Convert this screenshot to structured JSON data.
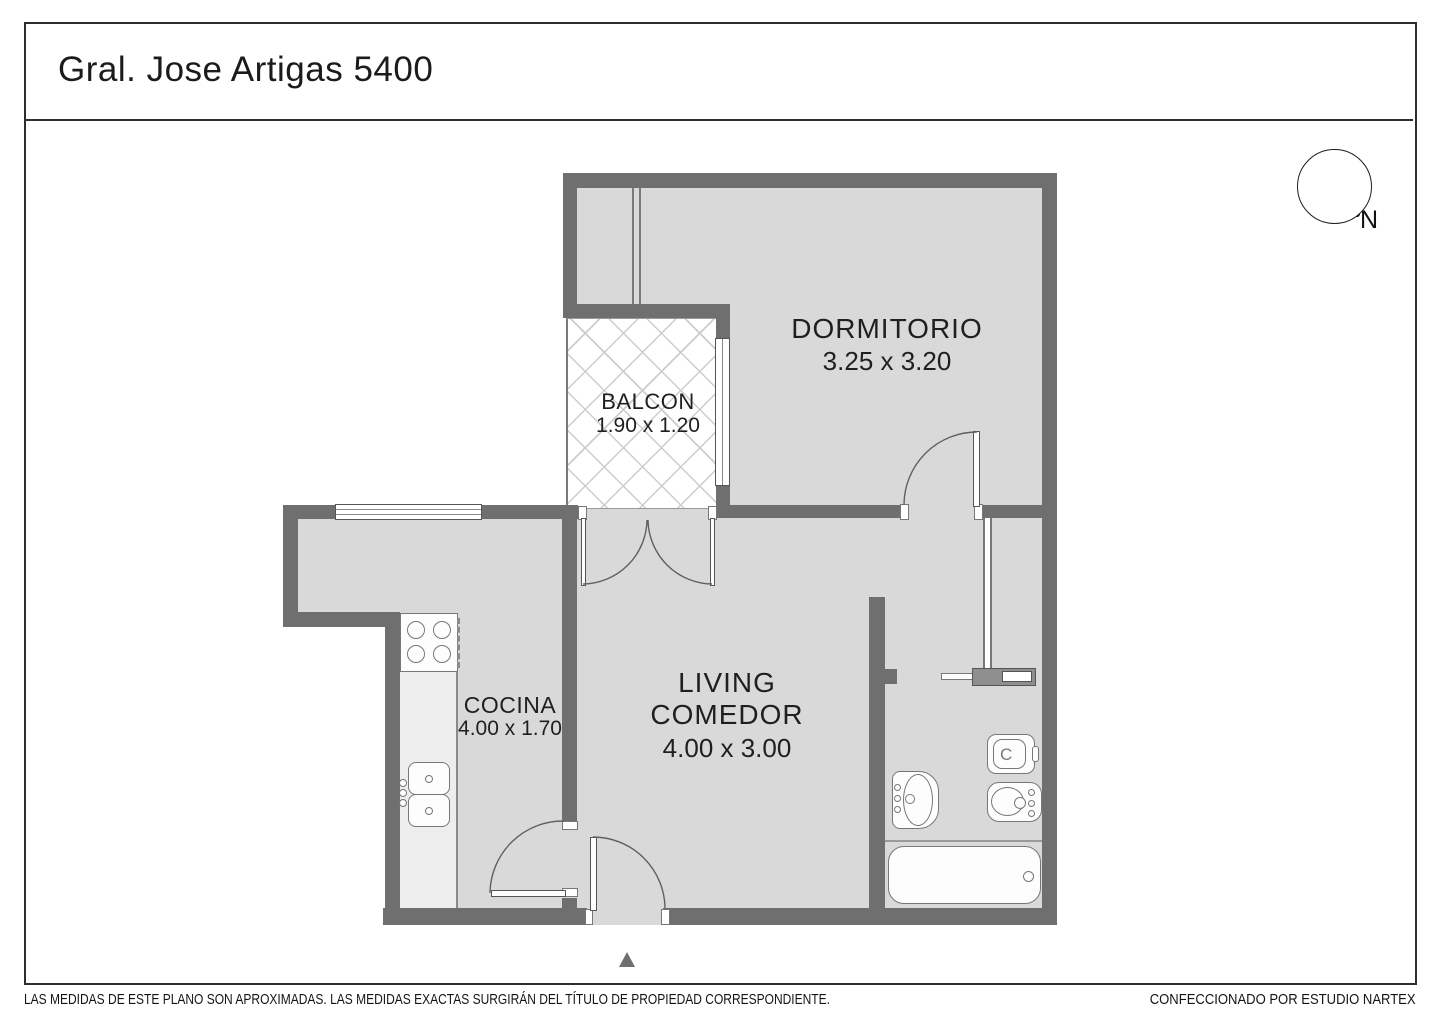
{
  "title": "Gral. Jose Artigas 5400",
  "compass": {
    "north_label": "N"
  },
  "rooms": {
    "dormitorio": {
      "name": "DORMITORIO",
      "dims": "3.25 x 3.20"
    },
    "balcon": {
      "name": "BALCON",
      "dims": "1.90 x 1.20"
    },
    "living": {
      "line1": "LIVING",
      "line2": "COMEDOR",
      "dims": "4.00 x 3.00"
    },
    "cocina": {
      "name": "COCINA",
      "dims": "4.00 x 1.70"
    }
  },
  "toilet_mark": "C",
  "footer": {
    "disclaimer": "LAS MEDIDAS  DE ESTE PLANO SON APROXIMADAS. LAS MEDIDAS EXACTAS SURGIRÁN DEL TÍTULO DE PROPIEDAD CORRESPONDIENTE.",
    "credit": "CONFECCIONADO POR ESTUDIO NARTEX"
  },
  "colors": {
    "wall": "#6f6f6f",
    "floor": "#d9d9d9",
    "counter": "#ededed",
    "hatch": "#cccccc",
    "text": "#1c1c1c"
  }
}
